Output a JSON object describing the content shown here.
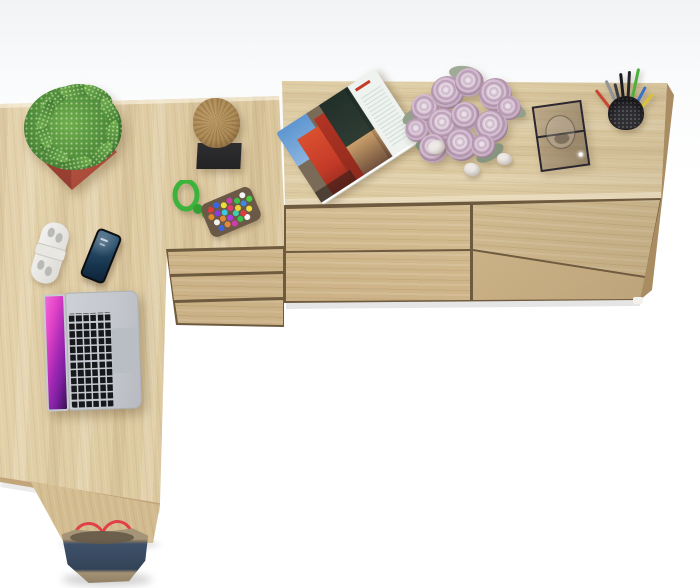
{
  "image": {
    "kind": "furniture product render",
    "view": "top-down studio shot",
    "background_color": "#ffffff",
    "visible_text": "none"
  },
  "furniture": {
    "desk": {
      "label": "L-shaped corner desk, sonoma oak",
      "surface_color": "#d6c094"
    },
    "pedestal": {
      "label": "three-drawer desk pedestal, sonoma oak",
      "drawers_visible": 3
    },
    "sideboard": {
      "label": "wide four-drawer sideboard chest, sonoma oak",
      "drawers_visible": 4,
      "foot_color": "#f3f1ed"
    }
  },
  "props": {
    "plant": {
      "label": "speckled green succulent in red square planter"
    },
    "log_decor": {
      "label": "natural wood log ornament on black square base"
    },
    "keychain": {
      "label": "green paracord keychain with multicolor beaded tag"
    },
    "safety_lock": {
      "label": "white furniture safety lock"
    },
    "smartphone": {
      "label": "black smartphone with dark blue lock screen"
    },
    "laptop": {
      "label": "open silver laptop with magenta abstract wallpaper"
    },
    "magazine": {
      "label": "open magazine with red architecture photo spread"
    },
    "roses": {
      "label": "bouquet of dusty pink roses"
    },
    "petals": {
      "label": "pale fallen petals",
      "count": 3
    },
    "display_box": {
      "label": "black framed glass display box"
    },
    "pencil_cup": {
      "label": "black mesh pencil cup with pens and pencils"
    },
    "tote_bag": {
      "label": "navy tote bag with red straps"
    }
  },
  "colors": {
    "bg": "#ffffff",
    "bg_top": "#f2f3f5",
    "wood_light": "#e4d3ad",
    "wood_mid": "#d6c094",
    "wood_dark": "#c4a97c",
    "wood_deep": "#a98c61",
    "seam": "#6e5a3e",
    "pot_light": "#b2503e",
    "pot_dark": "#8e3a2e",
    "leaf_light": "#6fae4d",
    "leaf_mid": "#4e8c3a",
    "leaf_dark": "#2f6428",
    "log": "#ad8b57",
    "base_black": "#232326",
    "cord_green": "#3cb43c",
    "tag_base": "#6b5948",
    "lock_white": "#f2f2f0",
    "lock_grey": "#b9b9b6",
    "phone_black": "#0c0d10",
    "screen_blue": "#274b68",
    "silver": "#cdd1d6",
    "keys_black": "#17181b",
    "trackpad": "#b9bec4",
    "screen_pink": "#e545c8",
    "screen_purple": "#7a1f9e",
    "mag_red": "#c43a28",
    "mag_sky": "#5e96d0",
    "mag_trees": "#2e3c34",
    "mag_page": "#eef3f0",
    "rose_light": "#e6d6e4",
    "rose_mid": "#c2a4be",
    "rose_deep": "#96758e",
    "rose_leaf": "#93a18b",
    "petal": "#efeae8",
    "glass_frame": "#2a2730",
    "cup_black": "#2e2e33",
    "pen_green": "#4cb03c",
    "pen_red": "#c8452f",
    "pen_blue": "#3a72c8",
    "pen_yellow": "#d8c23a",
    "pen_grey": "#8f949a",
    "bag_navy": "#3d5068",
    "bag_trim": "#a69478",
    "strap_red": "#e04048"
  }
}
